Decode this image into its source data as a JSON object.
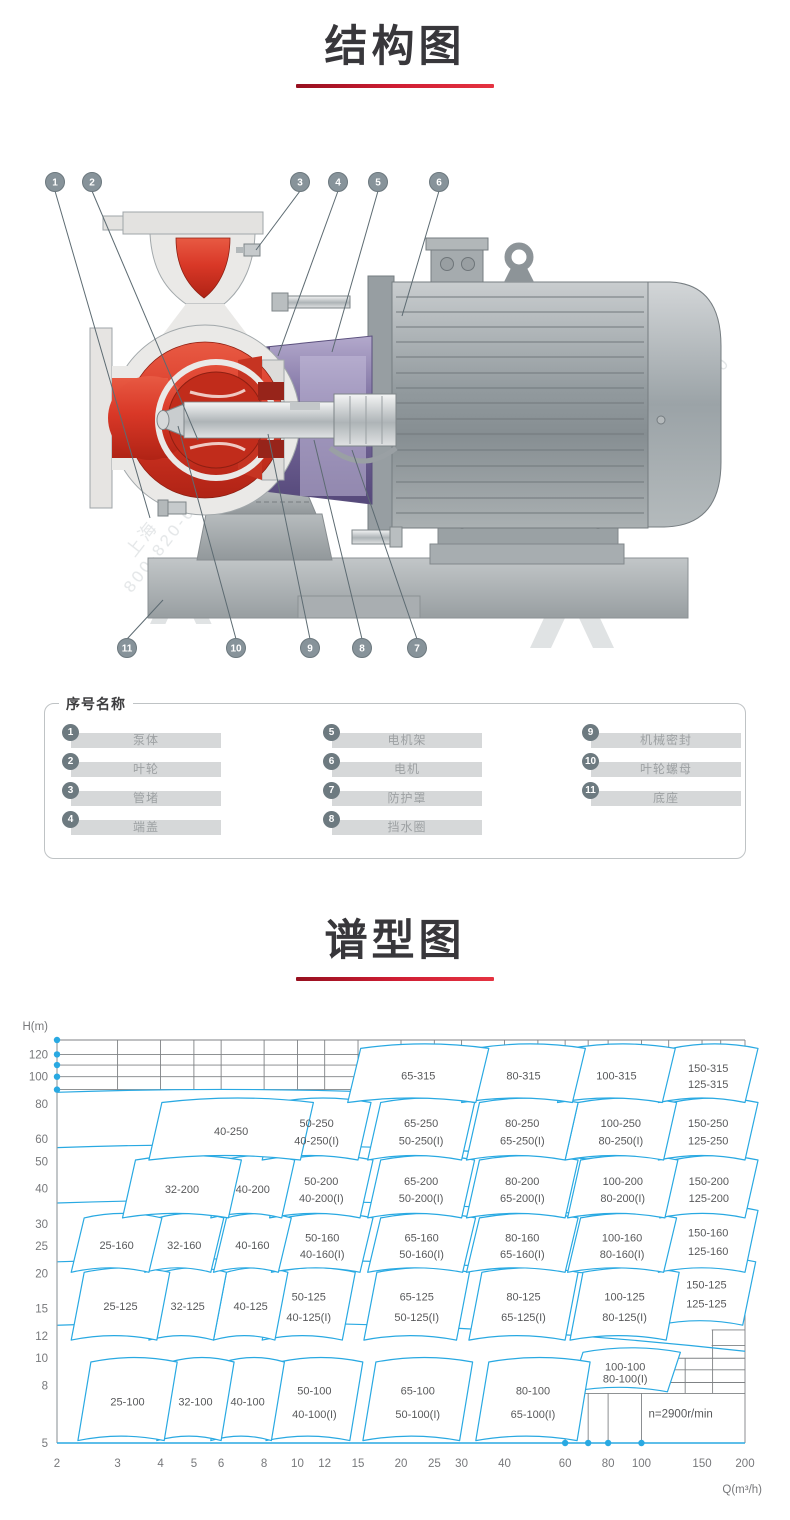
{
  "page": {
    "background": "#ffffff"
  },
  "sections": {
    "structure_title": "结构图",
    "spectrum_title": "谱型图"
  },
  "accent": {
    "underline_red": "#cf1d33",
    "chart_blue": "#29a9e2",
    "text_gray": "#6d6e71"
  },
  "diagram": {
    "callouts_top": [
      "1",
      "2",
      "3",
      "4",
      "5",
      "6"
    ],
    "callouts_bottom": [
      "11",
      "10",
      "9",
      "8",
      "7"
    ],
    "watermark": {
      "brand": "上海",
      "phone": "800-820-6570"
    },
    "colors": {
      "casing_red": "#d93827",
      "bracket_purple": "#6a5c90",
      "metal_gray": "#a9aeb1"
    }
  },
  "legend": {
    "title": "序号名称",
    "items": [
      {
        "no": "1",
        "name": "泵体"
      },
      {
        "no": "2",
        "name": "叶轮"
      },
      {
        "no": "3",
        "name": "管堵"
      },
      {
        "no": "4",
        "name": "端盖"
      },
      {
        "no": "5",
        "name": "电机架"
      },
      {
        "no": "6",
        "name": "电机"
      },
      {
        "no": "7",
        "name": "防护罩"
      },
      {
        "no": "8",
        "name": "挡水圈"
      },
      {
        "no": "9",
        "name": "机械密封"
      },
      {
        "no": "10",
        "name": "叶轮螺母"
      },
      {
        "no": "11",
        "name": "底座"
      }
    ]
  },
  "chart_data": {
    "type": "area",
    "subtype": "pump-selection-region-map",
    "title": "谱型图",
    "xlabel": "Q(m³/h)",
    "ylabel": "H(m)",
    "scale": "log-log",
    "x_range": [
      2,
      200
    ],
    "y_range": [
      5,
      135
    ],
    "x_ticks": [
      2,
      3,
      4,
      5,
      6,
      8,
      10,
      12,
      15,
      20,
      25,
      30,
      40,
      60,
      80,
      100,
      150,
      200
    ],
    "y_ticks": [
      5,
      8,
      10,
      12,
      15,
      20,
      25,
      30,
      40,
      50,
      60,
      80,
      100,
      120
    ],
    "annotation": "n=2900r/min",
    "axis_dots_h": [
      135,
      120,
      110,
      100,
      90
    ],
    "axis_dots_q": [
      60,
      70,
      80,
      100
    ],
    "top_grid_h": [
      135,
      120,
      110,
      100,
      90
    ],
    "top_grid_v_q": [
      3,
      4,
      5,
      6,
      8,
      10,
      12,
      15,
      20,
      25,
      30,
      40,
      50,
      60,
      70,
      80,
      100,
      120,
      150,
      170
    ],
    "row_boundaries_h": [
      88,
      56,
      35.6,
      22,
      13.1
    ],
    "corner_grid": {
      "v_q": [
        60,
        70,
        80,
        100
      ],
      "v_h_span": [
        7.5,
        5.1
      ],
      "h_lines": [
        {
          "h": 7.5,
          "q": [
            60,
            200
          ]
        },
        {
          "h": 8.2,
          "q": [
            110,
            200
          ]
        },
        {
          "h": 9.1,
          "q": [
            110,
            200
          ]
        },
        {
          "h": 10,
          "q": [
            110,
            200
          ]
        },
        {
          "h": 11.1,
          "q": [
            160,
            200
          ]
        },
        {
          "h": 12.6,
          "q": [
            160,
            200
          ]
        }
      ],
      "inner_v": [
        {
          "q": 134,
          "h": [
            10,
            7.5
          ]
        },
        {
          "q": 161,
          "h": [
            12.6,
            7.5
          ]
        }
      ]
    },
    "regions": [
      {
        "labels": [
          "65-315"
        ],
        "q": [
          14,
          33
        ],
        "h": [
          81,
          126
        ]
      },
      {
        "labels": [
          "80-315"
        ],
        "q": [
          30,
          63
        ],
        "h": [
          81,
          126
        ]
      },
      {
        "labels": [
          "100-315"
        ],
        "q": [
          57,
          115
        ],
        "h": [
          81,
          126
        ]
      },
      {
        "labels": [
          "150-315",
          "125-315"
        ],
        "q": [
          112,
          200
        ],
        "h": [
          81,
          126
        ]
      },
      {
        "labels": [
          "40-250"
        ],
        "q": [
          3.7,
          10.2
        ],
        "h": [
          50.6,
          81
        ]
      },
      {
        "labels": [
          "50-250",
          "40-250(I)"
        ],
        "q": [
          7.9,
          15
        ],
        "h": [
          50.6,
          81
        ]
      },
      {
        "labels": [
          "65-250",
          "50-250(I)"
        ],
        "q": [
          16,
          30
        ],
        "h": [
          50.6,
          81
        ]
      },
      {
        "labels": [
          "80-250",
          "65-250(I)"
        ],
        "q": [
          31,
          60
        ],
        "h": [
          50.6,
          81
        ]
      },
      {
        "labels": [
          "100-250",
          "80-250(I)"
        ],
        "q": [
          60,
          116
        ],
        "h": [
          50.6,
          81
        ]
      },
      {
        "labels": [
          "150-250",
          "125-250"
        ],
        "q": [
          112,
          200
        ],
        "h": [
          50.6,
          81
        ]
      },
      {
        "labels": [
          "32-200"
        ],
        "q": [
          3.1,
          6.3
        ],
        "h": [
          31.5,
          50.6
        ]
      },
      {
        "labels": [
          "40-200"
        ],
        "q": [
          5.6,
          9
        ],
        "h": [
          31.5,
          50.6
        ]
      },
      {
        "labels": [
          "50-200",
          "40-200(I)"
        ],
        "q": [
          8.3,
          15.2
        ],
        "h": [
          31.5,
          50.6
        ]
      },
      {
        "labels": [
          "65-200",
          "50-200(I)"
        ],
        "q": [
          16,
          30
        ],
        "h": [
          31.5,
          50.6
        ]
      },
      {
        "labels": [
          "80-200",
          "65-200(I)"
        ],
        "q": [
          31,
          60
        ],
        "h": [
          31.5,
          50.6
        ]
      },
      {
        "labels": [
          "100-200",
          "80-200(I)"
        ],
        "q": [
          61,
          117
        ],
        "h": [
          31.5,
          50.6
        ]
      },
      {
        "labels": [
          "150-200",
          "125-200"
        ],
        "q": [
          113,
          200
        ],
        "h": [
          31.5,
          50.6
        ]
      },
      {
        "labels": [
          "25-160"
        ],
        "q": [
          2.2,
          3.7
        ],
        "h": [
          20.2,
          31.5
        ]
      },
      {
        "labels": [
          "32-160"
        ],
        "q": [
          3.6,
          5.6
        ],
        "h": [
          20.2,
          31.5
        ]
      },
      {
        "labels": [
          "40-160"
        ],
        "q": [
          5.7,
          8.8
        ],
        "h": [
          20.2,
          31.5
        ]
      },
      {
        "labels": [
          "50-160",
          "40-160(I)"
        ],
        "q": [
          8.4,
          15.2
        ],
        "h": [
          20.2,
          31.5
        ]
      },
      {
        "labels": [
          "65-160",
          "50-160(I)"
        ],
        "q": [
          16,
          30.2
        ],
        "h": [
          20.2,
          31.5
        ]
      },
      {
        "labels": [
          "80-160",
          "65-160(I)"
        ],
        "q": [
          31,
          60
        ],
        "h": [
          20.2,
          31.5
        ]
      },
      {
        "labels": [
          "100-160",
          "80-160(I)"
        ],
        "q": [
          61,
          116
        ],
        "h": [
          20.2,
          31.5
        ]
      },
      {
        "labels": [
          "150-160",
          "125-160"
        ],
        "q": [
          112,
          200
        ],
        "h": [
          20.2,
          33.5
        ]
      },
      {
        "labels": [
          "25-125"
        ],
        "q": [
          2.2,
          3.9
        ],
        "h": [
          11.6,
          20.2
        ]
      },
      {
        "labels": [
          "32-125"
        ],
        "q": [
          3.7,
          5.7
        ],
        "h": [
          11.6,
          20.2
        ]
      },
      {
        "labels": [
          "40-125"
        ],
        "q": [
          5.7,
          8.6
        ],
        "h": [
          11.6,
          20.2
        ]
      },
      {
        "labels": [
          "50-125",
          "40-125(I)"
        ],
        "q": [
          7.9,
          13.5
        ],
        "h": [
          11.6,
          20.2
        ]
      },
      {
        "labels": [
          "65-125",
          "50-125(I)"
        ],
        "q": [
          15.6,
          29
        ],
        "h": [
          11.6,
          20.2
        ]
      },
      {
        "labels": [
          "80-125",
          "65-125(I)"
        ],
        "q": [
          31.5,
          60
        ],
        "h": [
          11.6,
          20.2
        ]
      },
      {
        "labels": [
          "100-125",
          "80-125(I)"
        ],
        "q": [
          62,
          118
        ],
        "h": [
          11.6,
          20.2
        ]
      },
      {
        "labels": [
          "150-125",
          "125-125"
        ],
        "q": [
          111,
          197
        ],
        "h": [
          13.1,
          22
        ]
      },
      {
        "labels": [
          "25-100"
        ],
        "q": [
          2.3,
          4.1
        ],
        "h": [
          5.1,
          9.7
        ]
      },
      {
        "labels": [
          "32-100"
        ],
        "q": [
          3.9,
          6
        ],
        "h": [
          5.1,
          9.7
        ]
      },
      {
        "labels": [
          "40-100"
        ],
        "q": [
          5.6,
          8.4
        ],
        "h": [
          5.1,
          9.7
        ]
      },
      {
        "labels": [
          "50-100",
          "40-100(I)"
        ],
        "q": [
          8.1,
          14.2
        ],
        "h": [
          5.1,
          9.7
        ]
      },
      {
        "labels": [
          "65-100",
          "50-100(I)"
        ],
        "q": [
          15.5,
          29.6
        ],
        "h": [
          5.1,
          9.7
        ]
      },
      {
        "labels": [
          "80-100",
          "65-100(I)"
        ],
        "q": [
          33,
          65
        ],
        "h": [
          5.1,
          9.7
        ]
      },
      {
        "labels": [
          "100-100",
          "80-100(I)"
        ],
        "q": [
          62,
          119
        ],
        "h": [
          7.6,
          10.5
        ]
      }
    ]
  }
}
